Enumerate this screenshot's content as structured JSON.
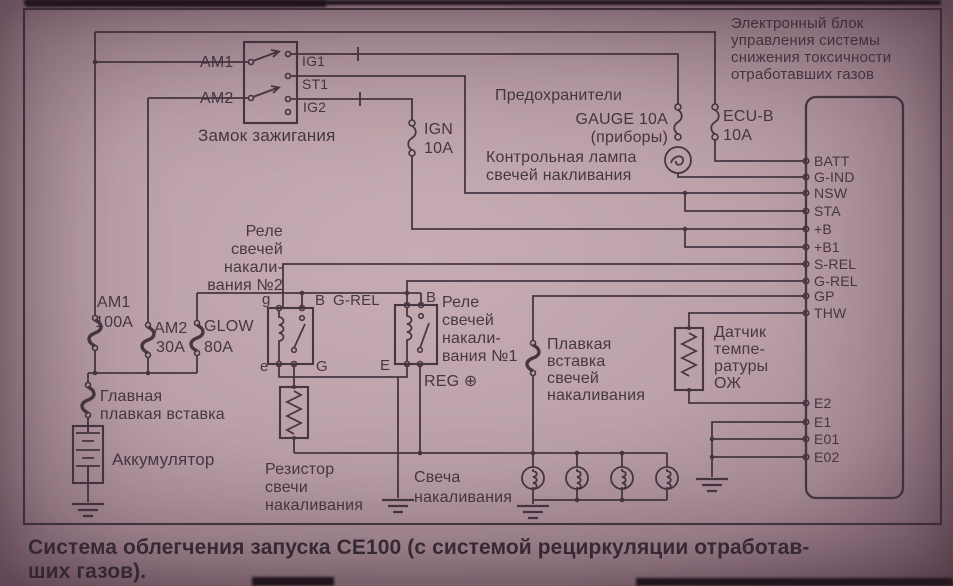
{
  "ecu": {
    "title_lines": [
      "Электронный блок",
      "управления системы",
      "снижения токсичности",
      "отработавших газов"
    ],
    "pins_top": [
      "BATT",
      "G-IND",
      "NSW",
      "STA",
      "+B",
      "+B1",
      "S-REL",
      "G-REL",
      "GP",
      "THW"
    ],
    "pins_bottom": [
      "E2",
      "E1",
      "E01",
      "E02"
    ]
  },
  "ignition_switch": {
    "label": "Замок зажигания",
    "am1": "AM1",
    "am2": "AM2",
    "ig1": "IG1",
    "st1": "ST1",
    "ig2": "IG2"
  },
  "fuse_panel": {
    "header": "Предохранители",
    "gauge": "GAUGE 10A",
    "gauge_sub": "(приборы)",
    "ecu_b": "ECU-B",
    "ecu_b_amp": "10A",
    "ign": "IGN",
    "ign_amp": "10A"
  },
  "glow_lamp": {
    "lines": [
      "Контрольная лампа",
      "свечей накливания"
    ]
  },
  "relay2": {
    "lines": [
      "Реле",
      "свечей",
      "накали-",
      "вания №2"
    ],
    "t_g": "g",
    "t_b": "B",
    "t_e": "e",
    "t_G": "G"
  },
  "relay1": {
    "lines": [
      "Реле",
      "свечей",
      "накали-",
      "вания №1"
    ],
    "t_b": "B",
    "t_e": "E",
    "wire_label": "G-REL",
    "reg": "REG ⊕"
  },
  "fusible_links": {
    "am1": "AM1",
    "am1_amp": "100A",
    "am2": "AM2",
    "am2_amp": "30A",
    "glow": "GLOW",
    "glow_amp": "80A",
    "main_lines": [
      "Главная",
      "плавкая вставка"
    ],
    "plug_link_lines": [
      "Плавкая",
      "вставка",
      "свечей",
      "накаливания"
    ]
  },
  "battery": {
    "label": "Аккумулятор"
  },
  "resistor": {
    "lines": [
      "Резистор",
      "свечи",
      "накаливания"
    ]
  },
  "glow_plugs": {
    "lines": [
      "Свеча",
      "накаливания"
    ]
  },
  "coolant_sensor": {
    "lines": [
      "Датчик",
      "темпе-",
      "ратуры",
      "ОЖ"
    ]
  },
  "caption": {
    "lines": [
      "Система облегчения запуска СЕ100 (с системой рециркуляции отработав-",
      "ших газов)."
    ]
  },
  "colors": {
    "ink": "#463743",
    "paper": "#bba0a8"
  }
}
